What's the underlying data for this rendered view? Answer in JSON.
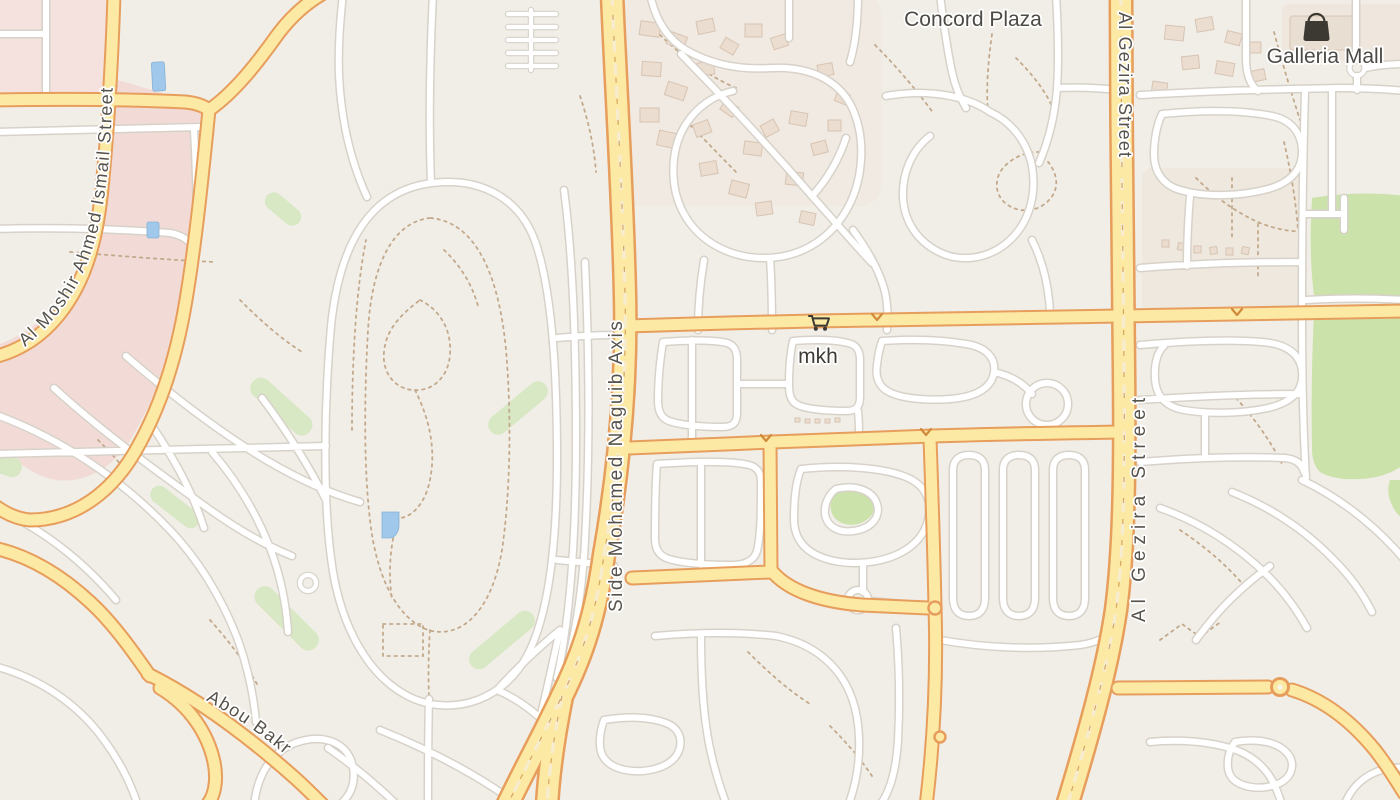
{
  "viewport": {
    "kind": "slippy-map",
    "width_px": 1400,
    "height_px": 800
  },
  "labels": {
    "poi": {
      "concord_plaza": "Concord Plaza",
      "galleria_mall": "Galleria Mall",
      "mkh": "mkh"
    },
    "streets": {
      "al_gezira_top": "Al Gezira Street",
      "al_gezira_mid": "Al Gezira Street",
      "side_mohamed_naguib_axis": "Side Mohamed Naguib Axis",
      "al_moshir_ahmed_ismail": "Al Moshir Ahmed Ismail Street",
      "abou_bakr": "Abou Bakr"
    }
  },
  "icons": {
    "galleria_mall_icon": "shopping-bag-icon",
    "mkh_icon": "shopping-cart-icon"
  },
  "palette": {
    "background": "#f1eee8",
    "primary_road_fill": "#fce9a4",
    "primary_road_casing": "#e79e5c",
    "minor_road_fill": "#ffffff",
    "minor_road_casing": "#d7d2c9",
    "park_green": "#cbe2aa",
    "grass_green": "#d9e8c4",
    "water_blue": "#9fc8ea",
    "residential_pink": "#f2dbd7",
    "footpath_dash": "#c3a98b",
    "label_text": "#4d4a45",
    "icon_dark": "#3c3933"
  }
}
